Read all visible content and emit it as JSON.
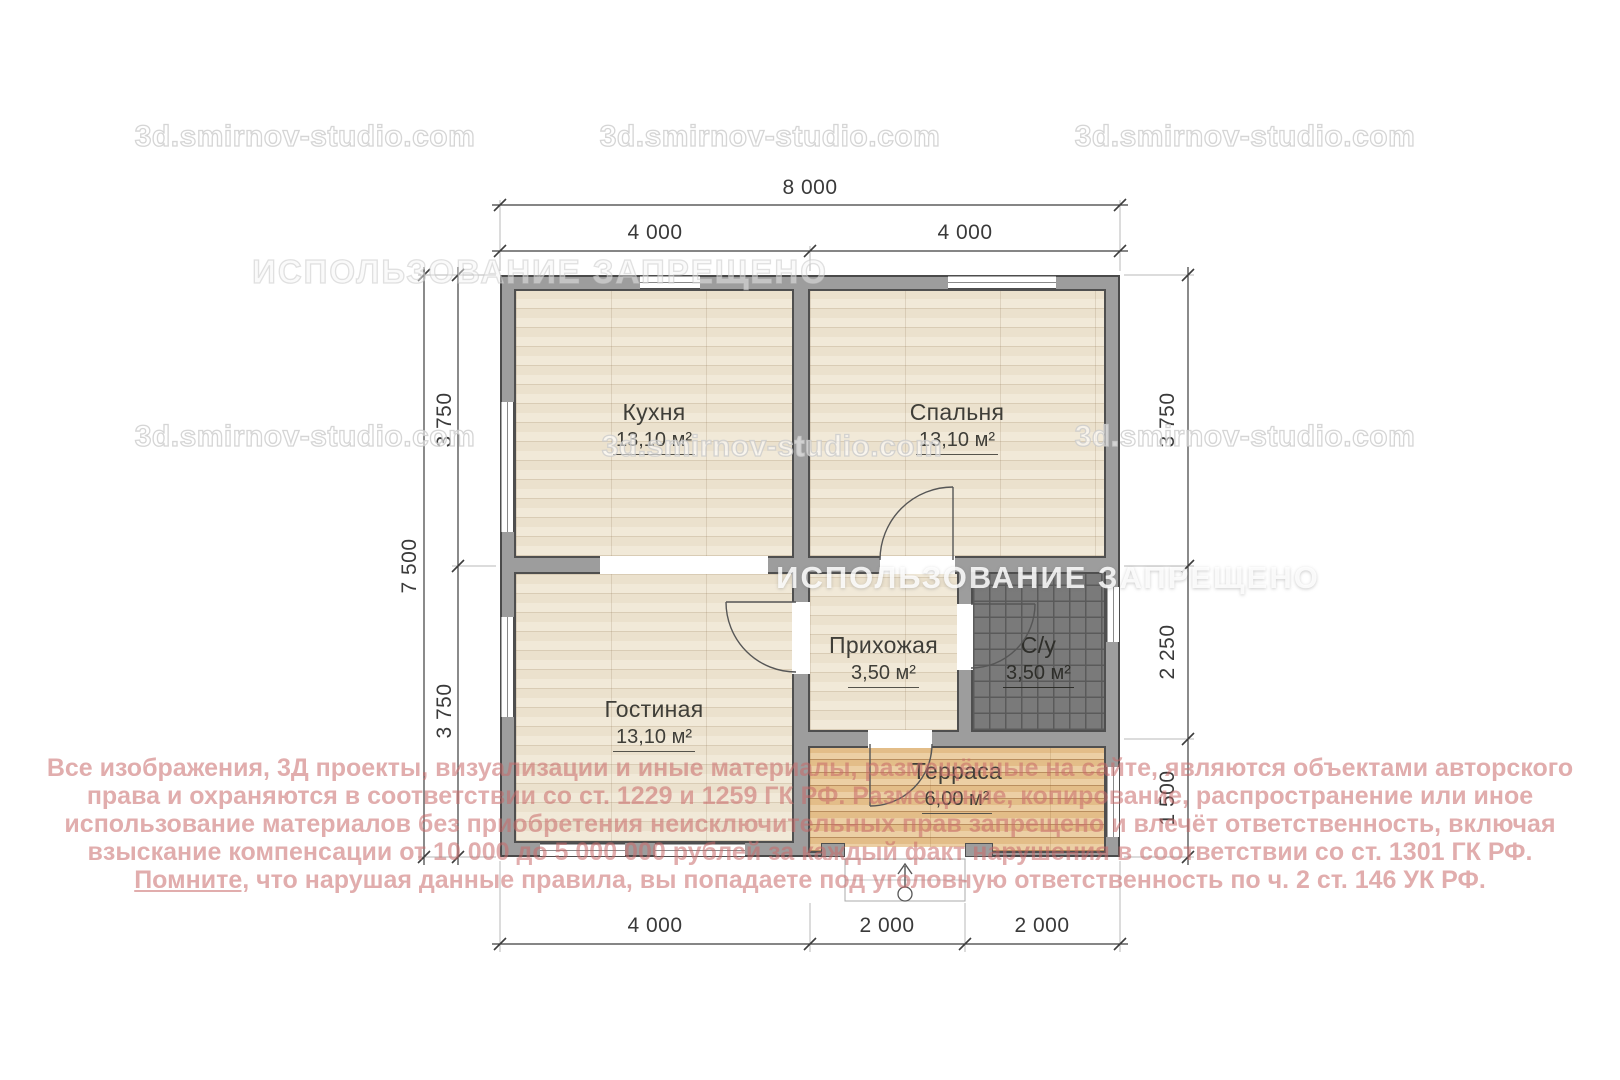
{
  "watermark": {
    "site": "3d.smirnov-studio.com",
    "ban": "ИСПОЛЬЗОВАНИЕ ЗАПРЕЩЕНО"
  },
  "plan": {
    "rooms": {
      "kitchen": {
        "name": "Кухня",
        "area": "13,10 м²"
      },
      "bedroom": {
        "name": "Спальня",
        "area": "13,10 м²"
      },
      "living": {
        "name": "Гостиная",
        "area": "13,10 м²"
      },
      "hallway": {
        "name": "Прихожая",
        "area": "3,50 м²"
      },
      "bathroom": {
        "name": "С/у",
        "area": "3,50 м²"
      },
      "terrace": {
        "name": "Терраса",
        "area": "6,00 м²"
      }
    }
  },
  "dimensions": {
    "top": {
      "total": "8 000",
      "seg1": "4 000",
      "seg2": "4 000"
    },
    "left": {
      "total": "7 500",
      "seg1": "3 750",
      "seg2": "3 750"
    },
    "right": {
      "seg1": "3 750",
      "seg2": "2 250",
      "seg3": "1 500"
    },
    "bottom": {
      "seg1": "4 000",
      "seg2": "2 000",
      "seg3": "2 000"
    }
  },
  "legal": {
    "line1": "Все изображения, 3Д проекты, визуализации и иные материалы, размещённые на сайте, являются объектами авторского",
    "line2": "права и охраняются в соответствии со ст. 1229 и 1259 ГК РФ. Размещение, копирование, распространение или иное",
    "line3": "использование материалов без приобретения неисключительных прав запрещено и влечёт ответственность, включая",
    "line4": "взыскание компенсации от 10 000 до 5 000 000 рублей за каждый факт нарушения в соответствии со ст. 1301 ГК РФ.",
    "line5_u": "Помните,",
    "line5_rest": "что нарушая данные правила, вы попадаете под уголовную ответственность по ч. 2 ст. 146 УК РФ."
  },
  "colors": {
    "wall": "#9d9d9d",
    "outline": "#4a4a4a",
    "floor_wood": "#efe6d4",
    "floor_terrace": "#eac793",
    "floor_tile": "#7a7a7a",
    "legal_text": "#c96a6a"
  }
}
